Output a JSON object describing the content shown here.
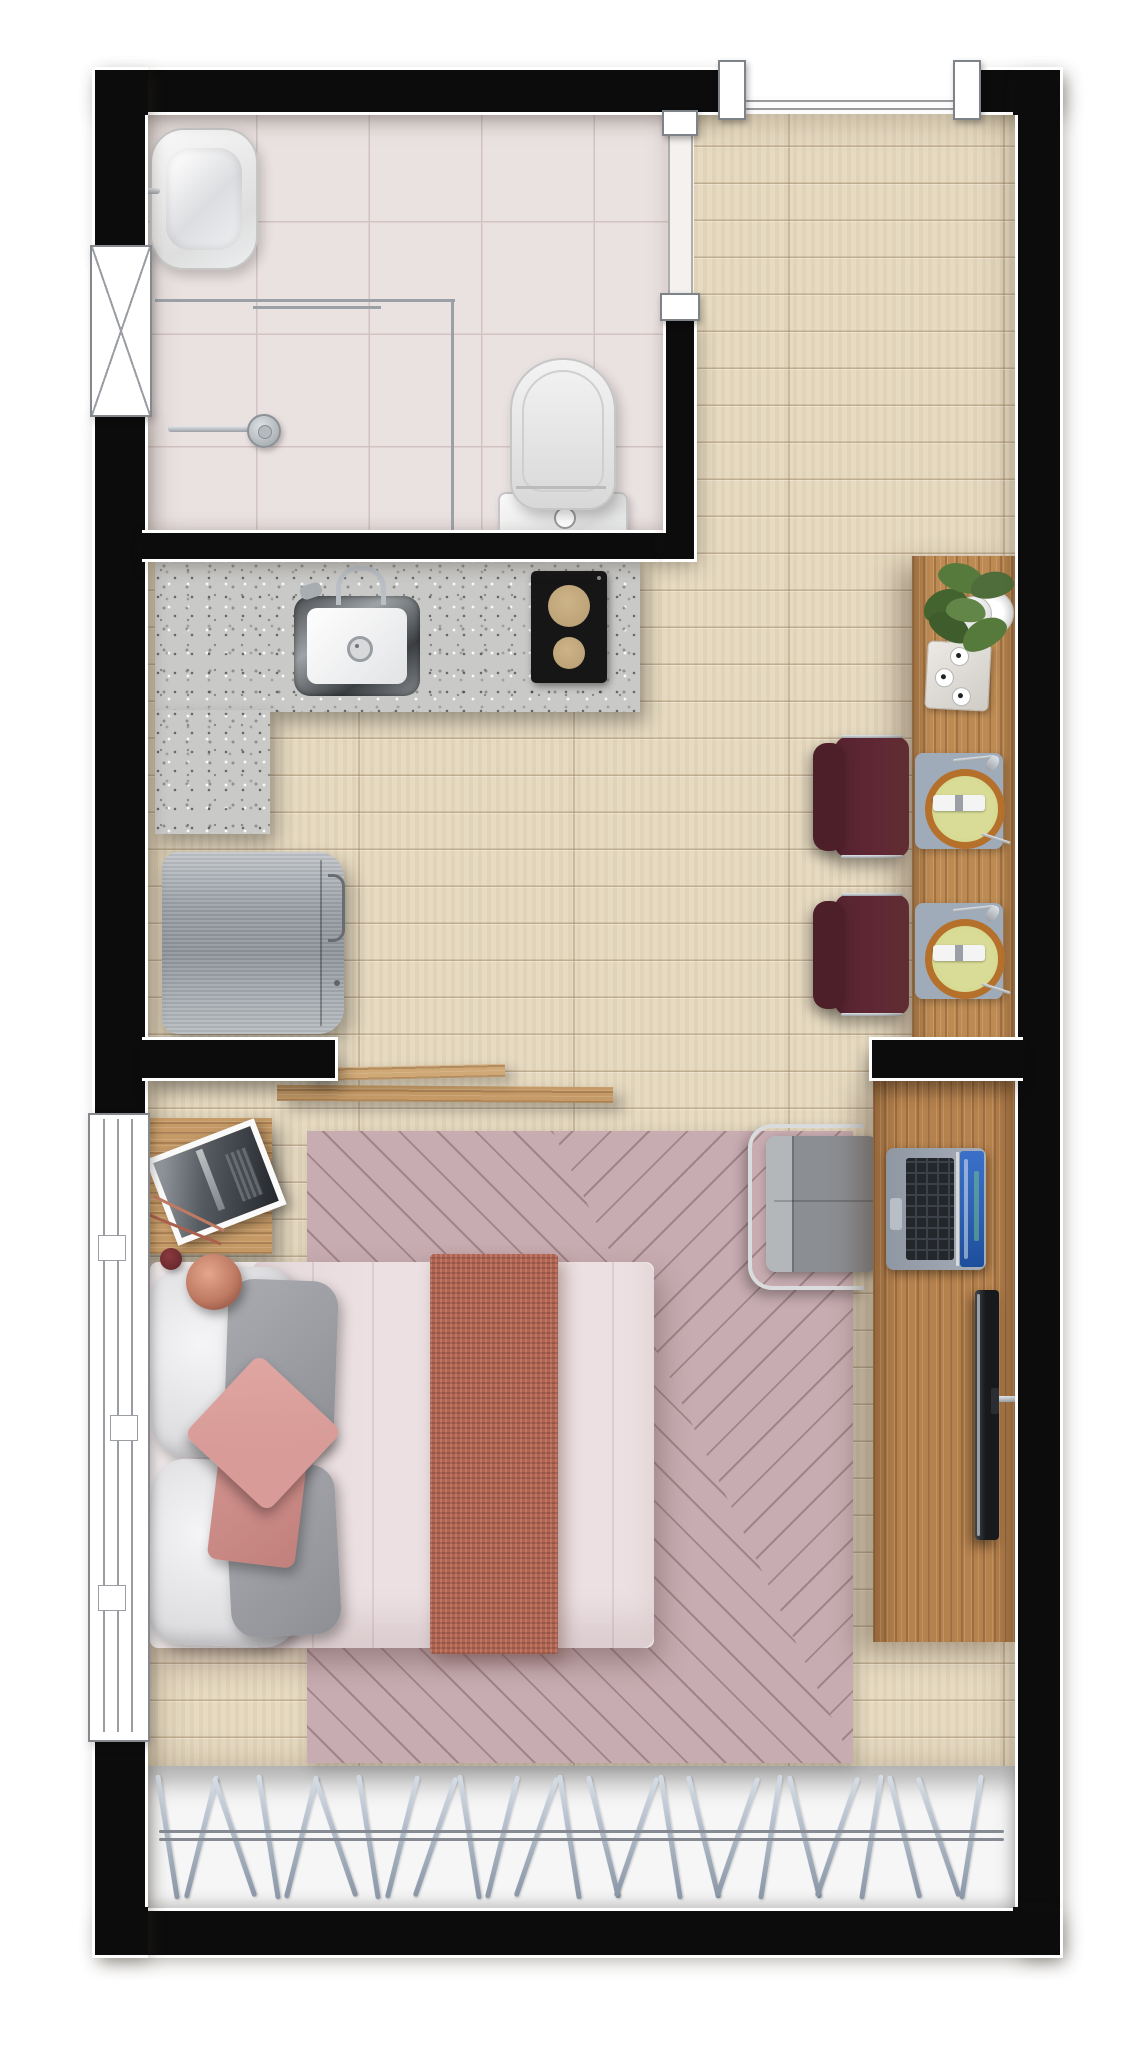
{
  "meta": {
    "content_type": "architectural-floor-plan-render",
    "view": "top-down",
    "unit": "studio-apartment"
  },
  "palette": {
    "bg": "#ffffff",
    "wall": "#0c0c0c",
    "outline": "#ffffff",
    "floor-wood": "#e6dac1",
    "tile": "#eae2e1",
    "tile-line": "#d2c3c2",
    "granite": "#c9c9c7",
    "counter-wood": "#bd8a52",
    "desk-wood": "#b5814c",
    "shelf-wood": "#c59a66",
    "chair-maroon": "#5e2733",
    "fridge-steel": "#a8aeb3",
    "rug": "#c7acb1",
    "rug-line": "#8d6e74",
    "duvet": "#ece0e2",
    "blanket": "#b26350",
    "pillow-gray": "#9b9ca2",
    "pillow-pink": "#d89b97",
    "lamp-copper": "#bf7a63",
    "plant-green": "#4e6d3a",
    "placemat-ring": "#b5702c",
    "placemat-center": "#cdd183",
    "mat-gray": "#9fabb8",
    "hanger-steel": "#a9b4c2",
    "laptop-screen": "#2f62b5",
    "tv-black": "#17191c",
    "glass-line": "#9aa0a5"
  },
  "closet": {
    "hanger_count": 25
  },
  "inventory": {
    "bathroom": [
      "washbasin",
      "basin-faucet",
      "shower-head",
      "shower-glass-partition",
      "toilet",
      "high-window",
      "door-opening"
    ],
    "kitchen": [
      "l-shaped-granite-counter",
      "kitchen-sink",
      "kitchen-faucet",
      "two-burner-cooktop",
      "refrigerator"
    ],
    "dining": [
      "wood-dining-counter",
      "dining-chair",
      "dining-chair",
      "potted-plant",
      "serving-tray",
      "place-setting",
      "place-setting"
    ],
    "bedroom": [
      "double-bed",
      "white-pillows",
      "gray-pillows",
      "pink-cushions",
      "throw-blanket",
      "chevron-rug",
      "bedside-table",
      "picture-frame",
      "copper-lamp",
      "wall-shelves",
      "desk",
      "desk-chair",
      "laptop",
      "tv-panel",
      "sliding-window",
      "closet-hanger-rail"
    ],
    "entry": [
      "entry-door-opening"
    ]
  }
}
